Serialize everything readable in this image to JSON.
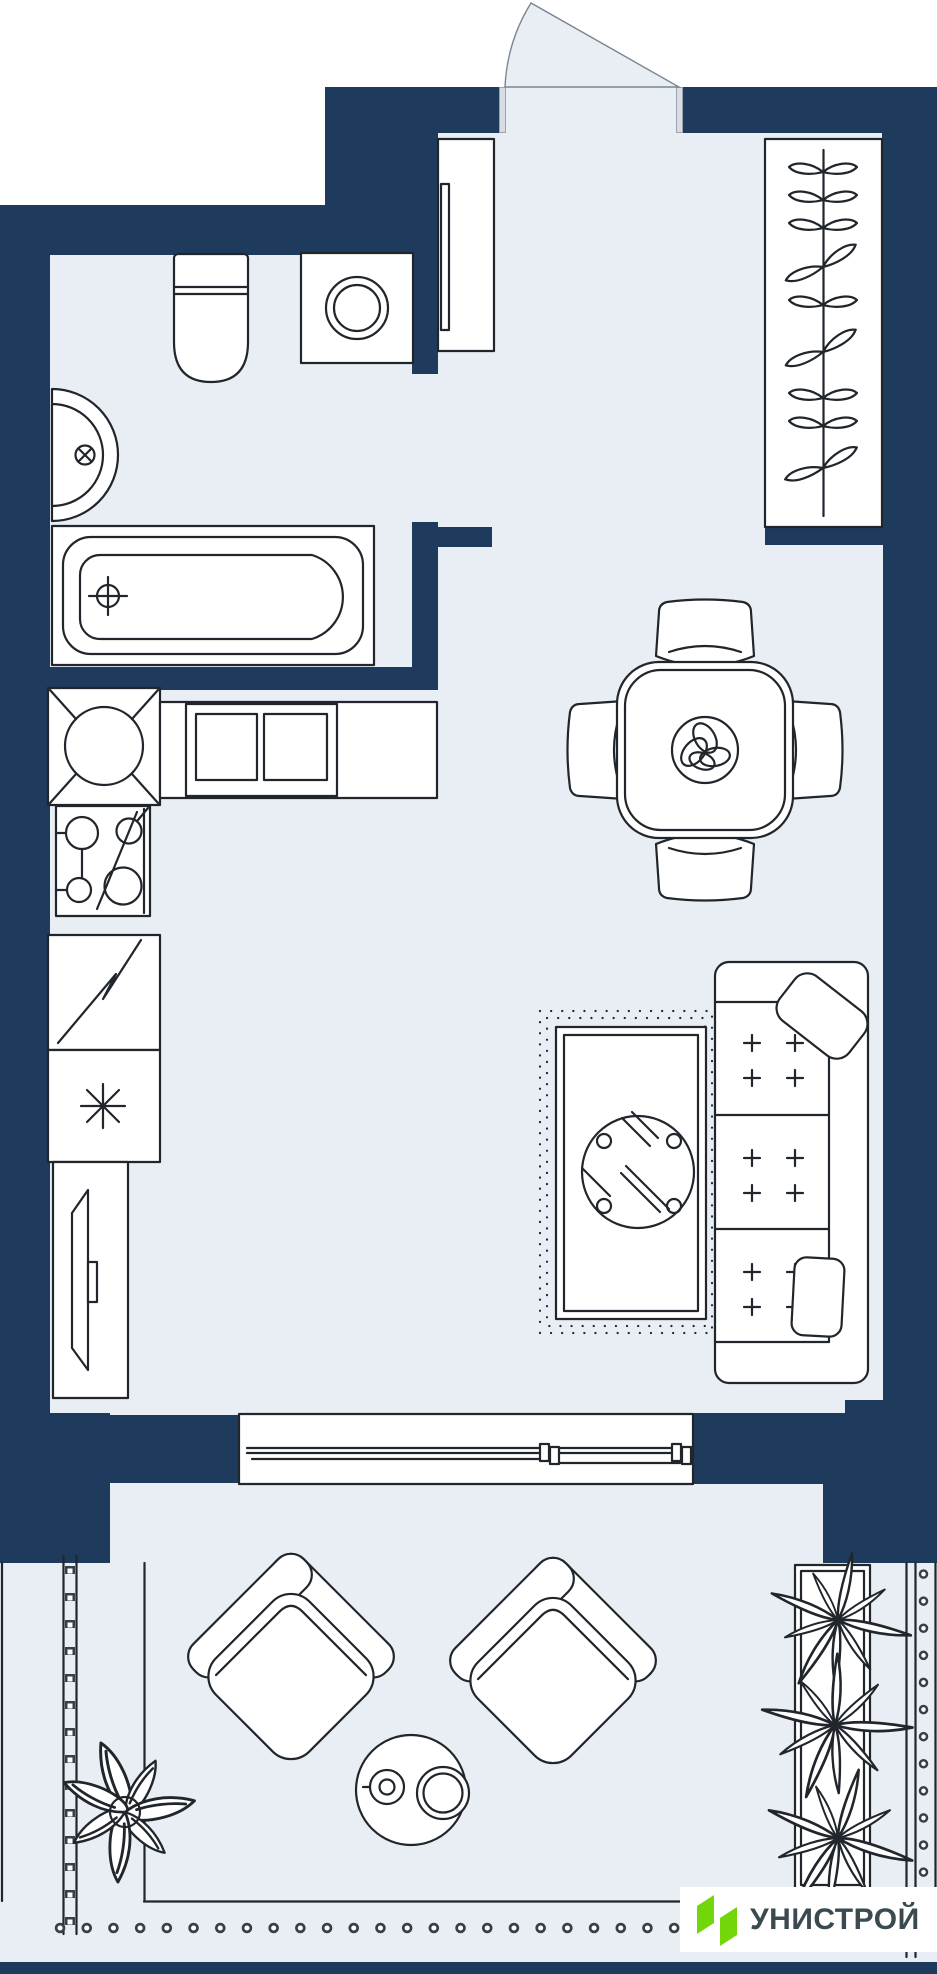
{
  "brand": {
    "name": "УНИСТРОЙ"
  },
  "colors": {
    "wall": "#1e3a5c",
    "floor": "#e9eef4",
    "outline": "#20262c",
    "logo-green": "#72d60a",
    "logo-text": "#3b4a50",
    "bg": "#ffffff"
  },
  "floorplan": {
    "type": "studio-apartment-plan",
    "rooms": [
      {
        "id": "bathroom",
        "label": "bathroom",
        "fixtures": [
          "toilet",
          "washing-machine",
          "corner-sink",
          "bathtub"
        ]
      },
      {
        "id": "hallway",
        "label": "entry hall",
        "fixtures": [
          "entry-door-swing",
          "hall-cabinet",
          "wardrobe-with-hangers"
        ]
      },
      {
        "id": "kitchen-living",
        "label": "kitchen / living room",
        "fixtures": [
          "kitchen-corner-sink-unit",
          "kitchen-counter",
          "cooktop",
          "appliance-unit-zigzag",
          "refrigerator-unit-snowflake",
          "tv-stand",
          "dining-table",
          "dining-chairs-x4",
          "table-centerpiece",
          "rug",
          "round-coffee-table",
          "sofa-3-seat",
          "pillows-x2",
          "balcony-sliding-door"
        ]
      },
      {
        "id": "balcony",
        "label": "balcony / terrace",
        "fixtures": [
          "armchair-rotated",
          "armchair-rotated",
          "round-side-table-with-cups",
          "potted-plant",
          "planter-box-with-plants",
          "railing-left",
          "railing-right",
          "railing-dots-bottom"
        ]
      }
    ]
  }
}
